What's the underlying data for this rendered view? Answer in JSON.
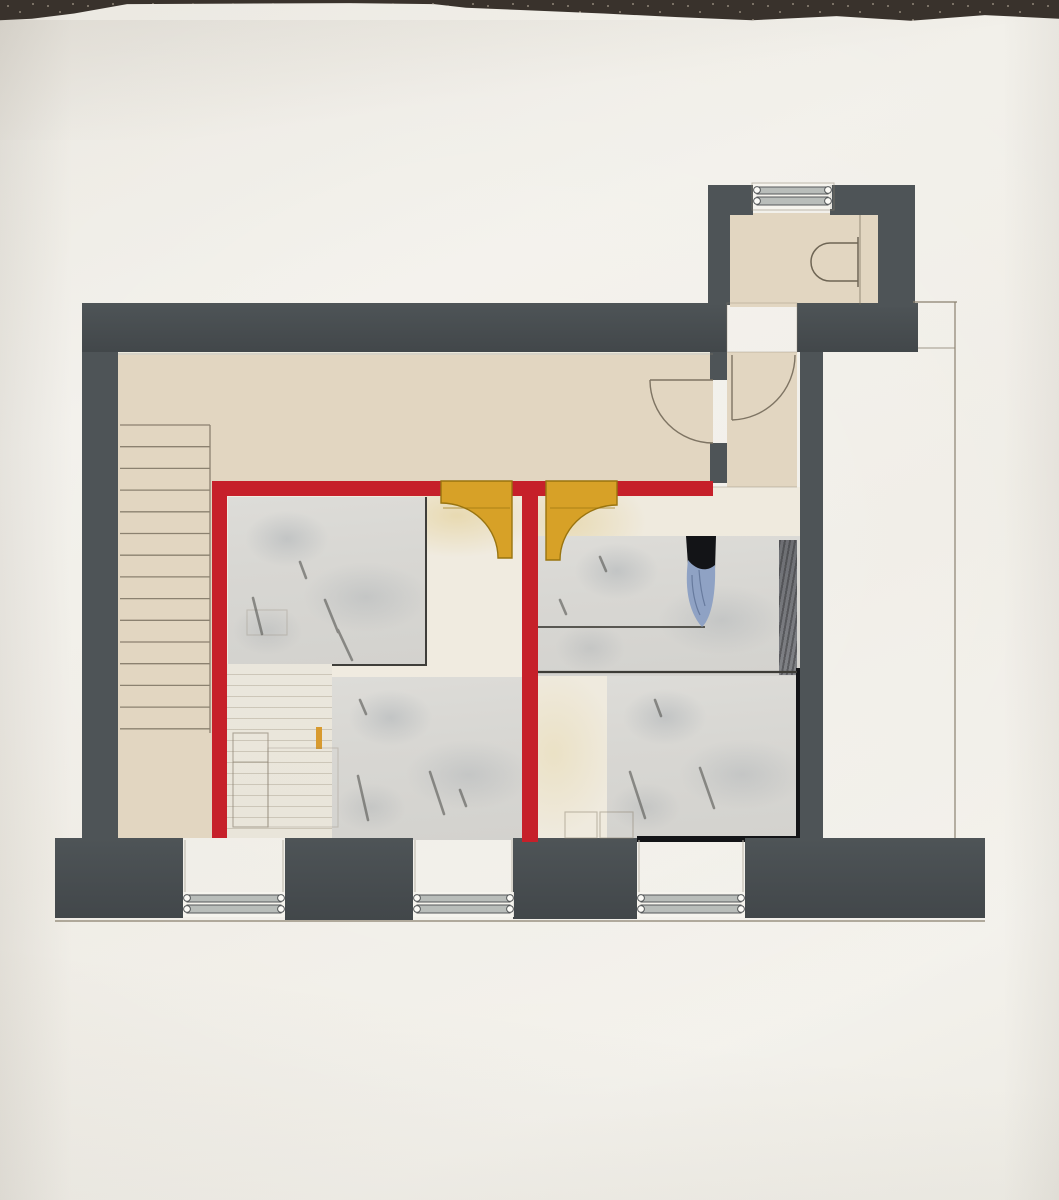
{
  "document": {
    "kind": "hand-made architectural floor plan collage, photographed on paper",
    "view": "top-down plan",
    "text_content": "none"
  },
  "palette": {
    "paper": "#f1efe8",
    "fabric": "#39322c",
    "fabric_speck": "#8f8678",
    "wall": "#4e5457",
    "wall_dark": "#42474a",
    "beige": "#e2d6c1",
    "red": "#c6202a",
    "yellow": "#d7a127",
    "yellow_edge": "#99740f",
    "collage": "#d8d7d3",
    "notebook": "#e9e5da",
    "floor_left": "#f0ebe0",
    "floor_right": "#efeade",
    "pencil": "#8b8170",
    "pencil_dark": "#7e7463",
    "charcoal": "#4a4a46",
    "ink_black": "#131417",
    "cutout_blue": "#8fa2c4",
    "cutout_blue_dark": "#5d7094",
    "window_bar": "#b9bdba",
    "window_bar_edge": "#55585a",
    "desk_line": "#46453f"
  },
  "stairs": {
    "step_count": 15,
    "x1": 120,
    "x2": 210,
    "y_top": 425,
    "spacing": 21.7
  },
  "bathroom_window": {
    "x": 757,
    "y": 187,
    "width": 71
  },
  "bottom_windows": [
    {
      "x": 187,
      "width": 94
    },
    {
      "x": 417,
      "width": 93
    },
    {
      "x": 641,
      "width": 100
    }
  ],
  "charcoal_dashes": [
    [
      253,
      598,
      262,
      634
    ],
    [
      325,
      600,
      338,
      632
    ],
    [
      338,
      630,
      352,
      660
    ],
    [
      300,
      562,
      306,
      578
    ],
    [
      358,
      776,
      368,
      820
    ],
    [
      430,
      772,
      444,
      814
    ],
    [
      460,
      790,
      466,
      806
    ],
    [
      360,
      700,
      366,
      714
    ],
    [
      630,
      772,
      645,
      818
    ],
    [
      700,
      768,
      714,
      808
    ],
    [
      655,
      700,
      661,
      716
    ],
    [
      600,
      557,
      606,
      571
    ],
    [
      560,
      600,
      566,
      614
    ]
  ],
  "legend_semantics": {
    "gray": "existing masonry walls",
    "red": "new partition walls",
    "yellow": "new door swings",
    "beige": "hallway, stair and bathroom floor",
    "collage_gray": "furnished room areas (collaged sketch paper)"
  }
}
